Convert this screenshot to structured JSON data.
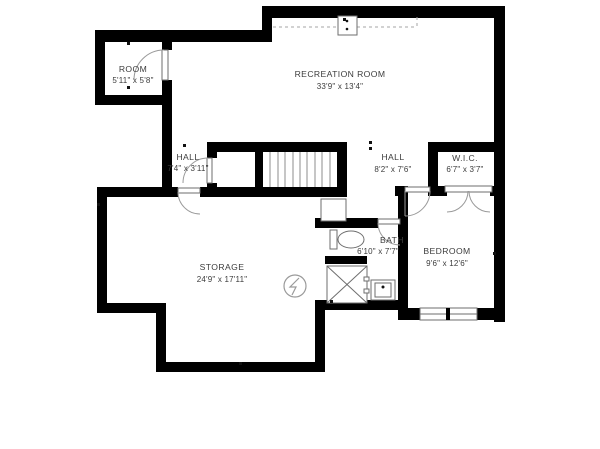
{
  "plan": {
    "type": "floor-plan",
    "level": "basement",
    "rooms": [
      {
        "name": "ROOM",
        "dimensions": "5'11\" x 5'8\""
      },
      {
        "name": "RECREATION ROOM",
        "dimensions": "33'9\" x 13'4\""
      },
      {
        "name": "HALL",
        "dimensions": "7'4\" x 3'11\""
      },
      {
        "name": "HALL",
        "dimensions": "8'2\" x 7'6\""
      },
      {
        "name": "W.I.C.",
        "dimensions": "6'7\" x 3'7\""
      },
      {
        "name": "STORAGE",
        "dimensions": "24'9\" x 17'11\""
      },
      {
        "name": "BATH",
        "dimensions": "6'10\" x 7'7\""
      },
      {
        "name": "BEDROOM",
        "dimensions": "9'6\" x 12'6\""
      }
    ],
    "symbols": [
      "stairs",
      "electrical-panel",
      "toilet",
      "shower",
      "sink",
      "window",
      "doors"
    ],
    "colors": {
      "wall": "#000000",
      "background": "#ffffff",
      "fixture_stroke": "#9a9a9a",
      "text": "#3c3c3c"
    }
  }
}
